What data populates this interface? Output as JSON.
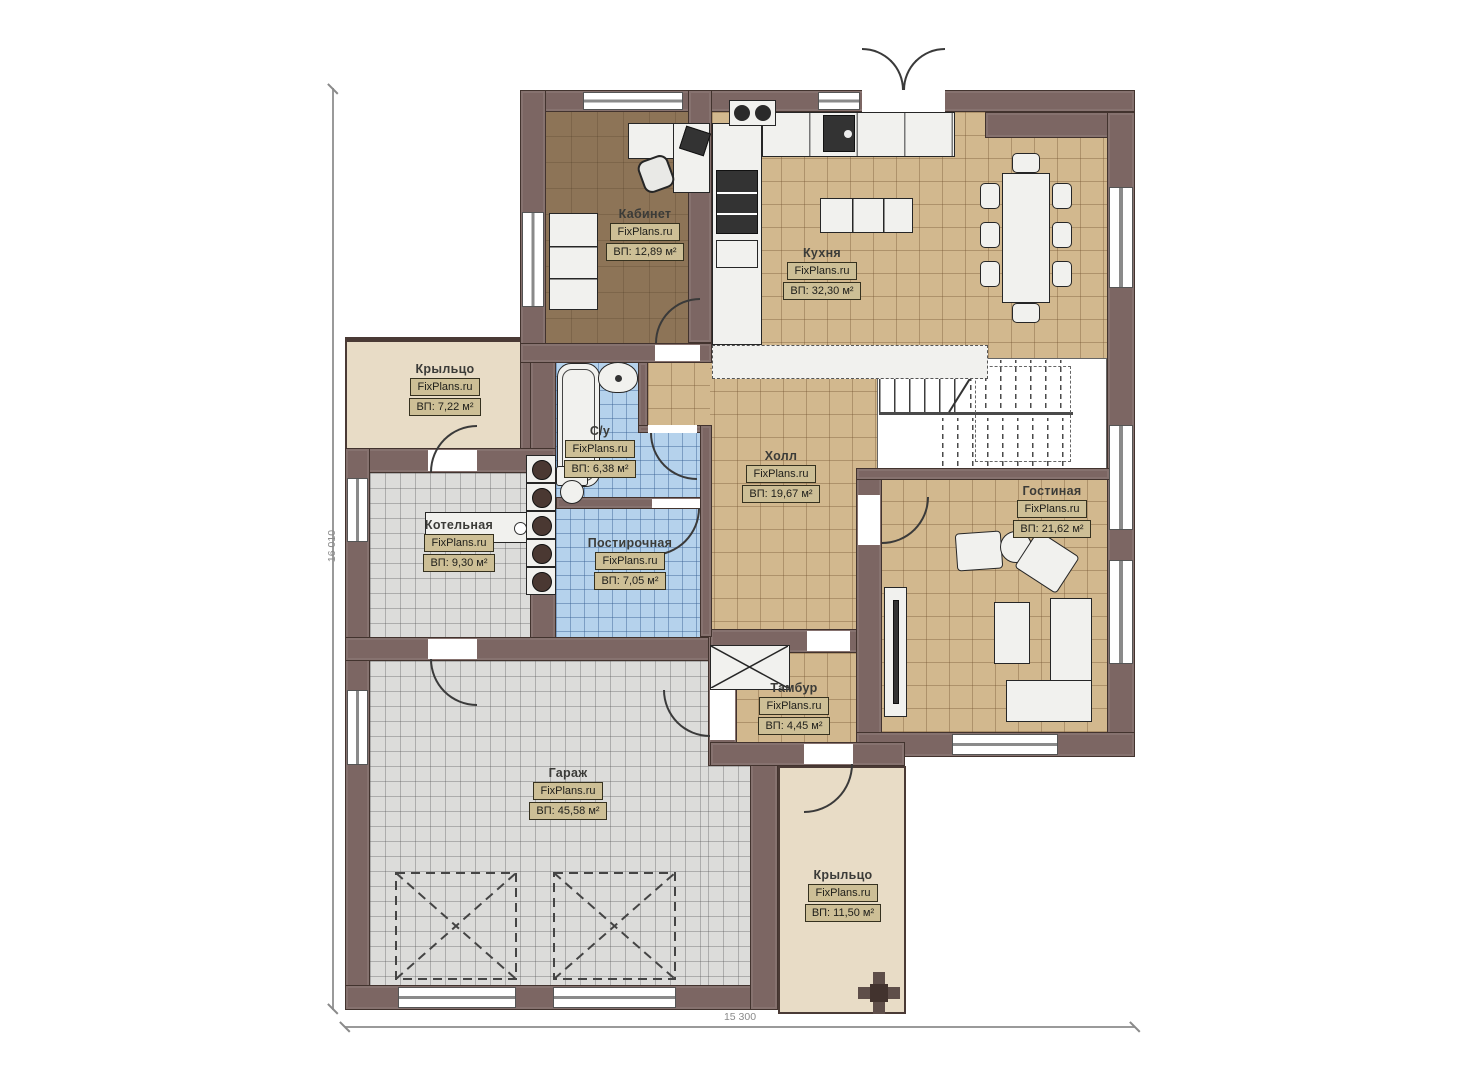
{
  "plan": {
    "brand": "FixPlans.ru",
    "dimensions": {
      "width": "15 300",
      "height": "16 010"
    },
    "rooms": [
      {
        "name": "Кабинет",
        "brand": "FixPlans.ru",
        "area": "ВП: 12,89 м²"
      },
      {
        "name": "Кухня",
        "brand": "FixPlans.ru",
        "area": "ВП: 32,30 м²"
      },
      {
        "name": "Крыльцо",
        "brand": "FixPlans.ru",
        "area": "ВП: 7,22 м²"
      },
      {
        "name": "С/у",
        "brand": "FixPlans.ru",
        "area": "ВП: 6,38 м²"
      },
      {
        "name": "Котельная",
        "brand": "FixPlans.ru",
        "area": "ВП: 9,30 м²"
      },
      {
        "name": "Постирочная",
        "brand": "FixPlans.ru",
        "area": "ВП: 7,05 м²"
      },
      {
        "name": "Холл",
        "brand": "FixPlans.ru",
        "area": "ВП: 19,67 м²"
      },
      {
        "name": "Гостиная",
        "brand": "FixPlans.ru",
        "area": "ВП: 21,62 м²"
      },
      {
        "name": "Тамбур",
        "brand": "FixPlans.ru",
        "area": "ВП: 4,45 м²"
      },
      {
        "name": "Гараж",
        "brand": "FixPlans.ru",
        "area": "ВП: 45,58 м²"
      },
      {
        "name": "Крыльцо",
        "brand": "FixPlans.ru",
        "area": "ВП: 11,50 м²"
      }
    ],
    "colors": {
      "wall": "#7c6663",
      "floor_tan": "#d2b88e",
      "floor_blue": "#b5d2ec",
      "floor_gray": "#dcdcda",
      "floor_office": "#8d7457",
      "porch": "#e8dcc6",
      "label_box": "#cdbf96"
    }
  }
}
